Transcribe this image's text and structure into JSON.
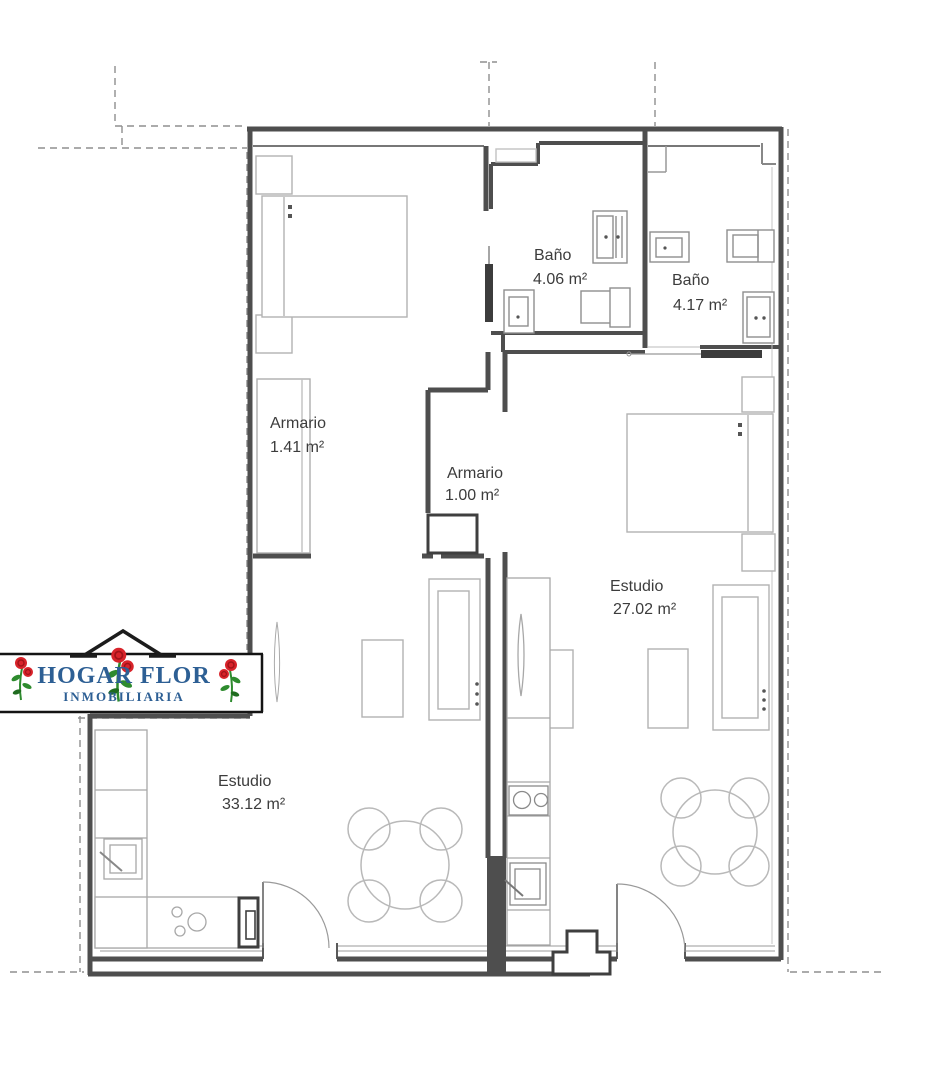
{
  "logo": {
    "title": "HOGAR FLOR",
    "subtitle": "INMOBILIARIA"
  },
  "rooms": {
    "bano1": {
      "label": "Baño",
      "area": "4.06 m²"
    },
    "bano2": {
      "label": "Baño",
      "area": "4.17 m²"
    },
    "armario1": {
      "label": "Armario",
      "area": "1.41 m²"
    },
    "armario2": {
      "label": "Armario",
      "area": "1.00 m²"
    },
    "estudio1": {
      "label": "Estudio",
      "area": "27.02 m²"
    },
    "estudio2": {
      "label": "Estudio",
      "area": "33.12 m²"
    }
  },
  "colors": {
    "wall": "#4e4e4e",
    "furniture_line": "#b2b2b2",
    "label_text": "#3c3c3c",
    "logo_blue": "#2d5f94",
    "rose_red": "#d8232a",
    "leaf_green": "#2e8b2e"
  }
}
